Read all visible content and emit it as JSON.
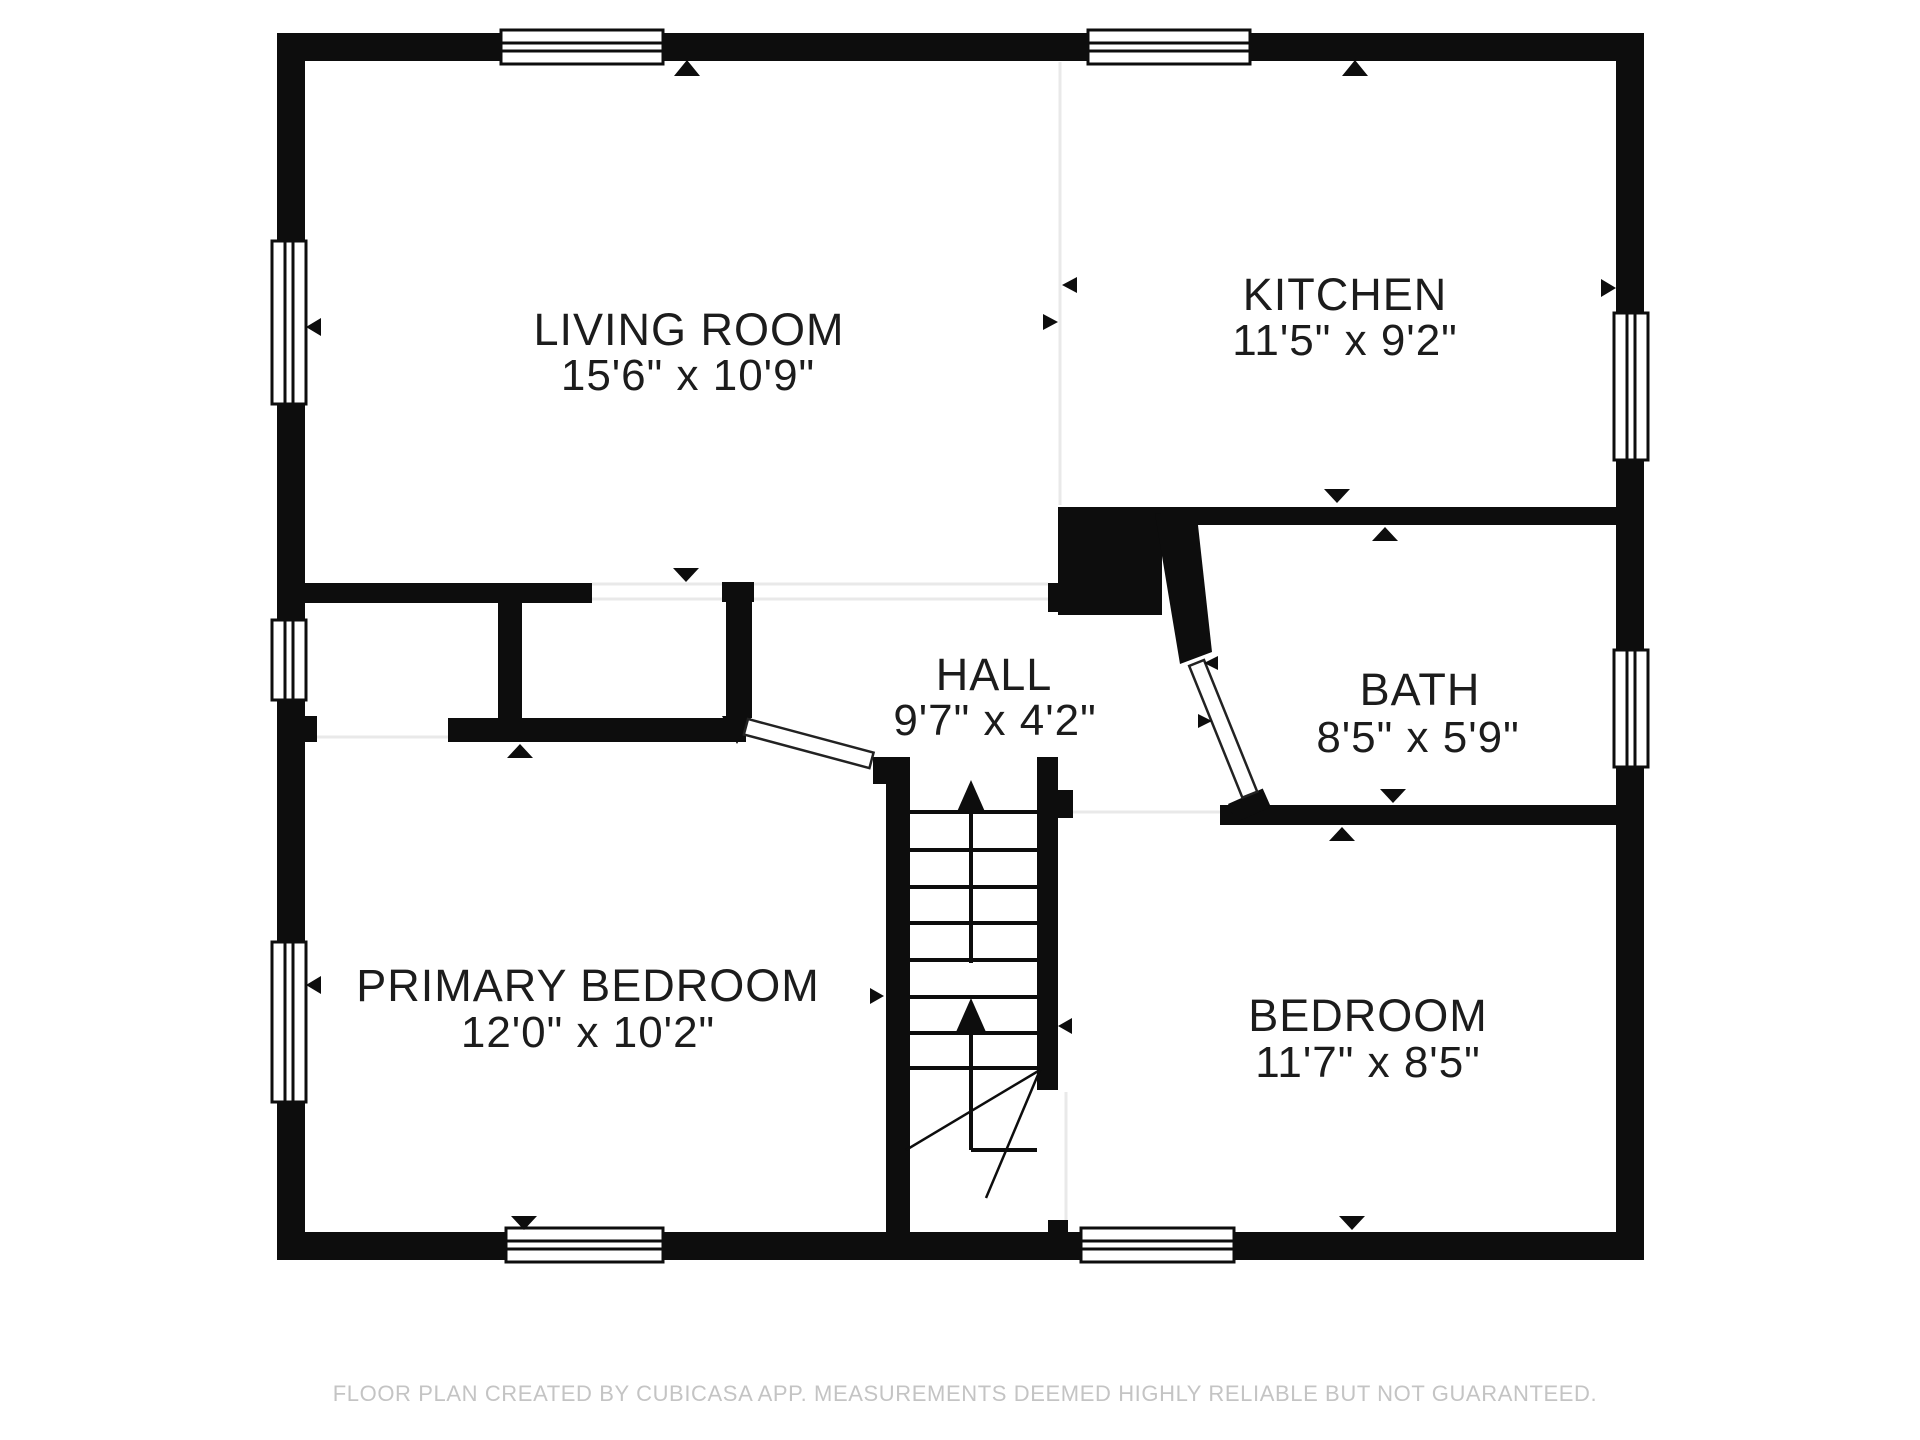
{
  "plan": {
    "type": "floor-plan",
    "creator_note": "CubiCasa",
    "rooms": {
      "living_room": {
        "name": "LIVING ROOM",
        "dimensions": "15'6\" x 10'9\""
      },
      "kitchen": {
        "name": "KITCHEN",
        "dimensions": "11'5\" x 9'2\""
      },
      "hall": {
        "name": "HALL",
        "dimensions": "9'7\" x 4'2\""
      },
      "bath": {
        "name": "BATH",
        "dimensions": "8'5\" x 5'9\""
      },
      "primary_bedroom": {
        "name": "PRIMARY BEDROOM",
        "dimensions": "12'0\" x 10'2\""
      },
      "bedroom": {
        "name": "BEDROOM",
        "dimensions": "11'7\" x 8'5\""
      }
    },
    "stairs": {
      "up_arrows": 2,
      "treads": 8
    },
    "window_count": 9,
    "colors": {
      "wall": "#0d0d0d",
      "label": "#1c1c1c",
      "open_boundary_line": "#e9e9e9",
      "footer": "#c4c4c4",
      "background": "#ffffff"
    }
  },
  "footer": {
    "text": "FLOOR PLAN CREATED BY CUBICASA APP. MEASUREMENTS DEEMED HIGHLY RELIABLE BUT NOT GUARANTEED."
  }
}
